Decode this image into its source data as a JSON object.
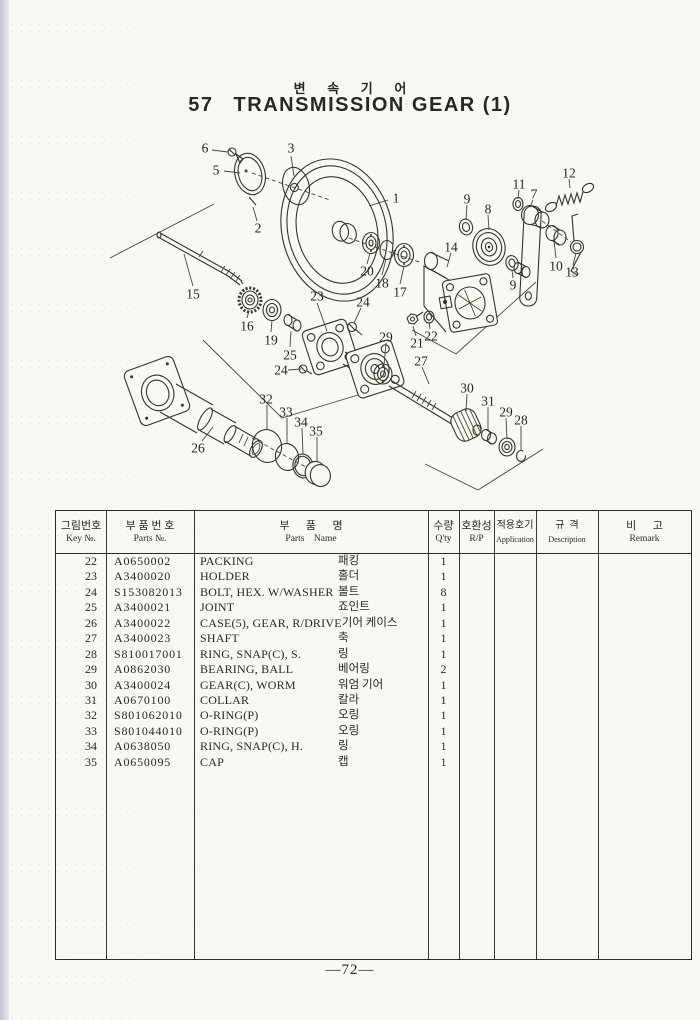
{
  "page": {
    "title_ko": "변 속 기 어",
    "title_no": "57",
    "title_en": "TRANSMISSION GEAR (1)",
    "page_number": "—72—"
  },
  "table": {
    "headers": [
      {
        "ko": "그림번호",
        "en": "Key №."
      },
      {
        "ko": "부 품 번 호",
        "en": "Parts №."
      },
      {
        "ko": "부      품      명",
        "en": "Parts    Name"
      },
      {
        "ko": "수량",
        "en": "Q'ty"
      },
      {
        "ko": "호환성",
        "en": "R/P"
      },
      {
        "ko": "적용호기",
        "en": "Application"
      },
      {
        "ko": "규  격",
        "en": "Description"
      },
      {
        "ko": "비      고",
        "en": "Remark"
      }
    ],
    "rows": [
      {
        "key": "22",
        "part_no": "A0650002",
        "name_en": "PACKING",
        "name_ko": "패킹",
        "qty": "1"
      },
      {
        "key": "23",
        "part_no": "A3400020",
        "name_en": "HOLDER",
        "name_ko": "홀더",
        "qty": "1"
      },
      {
        "key": "24",
        "part_no": "S153082013",
        "name_en": "BOLT, HEX. W/WASHER",
        "name_ko": "볼트",
        "qty": "8"
      },
      {
        "key": "25",
        "part_no": "A3400021",
        "name_en": "JOINT",
        "name_ko": "죠인트",
        "qty": "1"
      },
      {
        "key": "26",
        "part_no": "A3400022",
        "name_en": "CASE(5), GEAR, R/DRIVE",
        "name_ko": "기어 케이스",
        "qty": "1"
      },
      {
        "key": "27",
        "part_no": "A3400023",
        "name_en": "SHAFT",
        "name_ko": "축",
        "qty": "1"
      },
      {
        "key": "28",
        "part_no": "S810017001",
        "name_en": "RING, SNAP(C), S.",
        "name_ko": "링",
        "qty": "1"
      },
      {
        "key": "29",
        "part_no": "A0862030",
        "name_en": "BEARING, BALL",
        "name_ko": "베어링",
        "qty": "2"
      },
      {
        "key": "30",
        "part_no": "A3400024",
        "name_en": "GEAR(C), WORM",
        "name_ko": "워엄 기어",
        "qty": "1"
      },
      {
        "key": "31",
        "part_no": "A0670100",
        "name_en": "COLLAR",
        "name_ko": "칼라",
        "qty": "1"
      },
      {
        "key": "32",
        "part_no": "S801062010",
        "name_en": "O-RING(P)",
        "name_ko": "오링",
        "qty": "1"
      },
      {
        "key": "33",
        "part_no": "S801044010",
        "name_en": "O-RING(P)",
        "name_ko": "오링",
        "qty": "1"
      },
      {
        "key": "34",
        "part_no": "A0638050",
        "name_en": "RING, SNAP(C), H.",
        "name_ko": "링",
        "qty": "1"
      },
      {
        "key": "35",
        "part_no": "A0650095",
        "name_en": "CAP",
        "name_ko": "캡",
        "qty": "1"
      }
    ]
  },
  "diagram": {
    "callouts": [
      {
        "t": "6",
        "x": 205,
        "y": 148
      },
      {
        "t": "5",
        "x": 216,
        "y": 170
      },
      {
        "t": "3",
        "x": 291,
        "y": 148
      },
      {
        "t": "2",
        "x": 258,
        "y": 228
      },
      {
        "t": "1",
        "x": 396,
        "y": 198
      },
      {
        "t": "15",
        "x": 193,
        "y": 294
      },
      {
        "t": "16",
        "x": 247,
        "y": 326
      },
      {
        "t": "19",
        "x": 271,
        "y": 340
      },
      {
        "t": "25",
        "x": 290,
        "y": 355
      },
      {
        "t": "23",
        "x": 317,
        "y": 296
      },
      {
        "t": "24",
        "x": 363,
        "y": 302
      },
      {
        "t": "24",
        "x": 281,
        "y": 370
      },
      {
        "t": "20",
        "x": 367,
        "y": 271
      },
      {
        "t": "18",
        "x": 382,
        "y": 283
      },
      {
        "t": "17",
        "x": 400,
        "y": 292
      },
      {
        "t": "14",
        "x": 451,
        "y": 247
      },
      {
        "t": "9",
        "x": 467,
        "y": 199
      },
      {
        "t": "8",
        "x": 488,
        "y": 209
      },
      {
        "t": "9",
        "x": 513,
        "y": 285
      },
      {
        "t": "11",
        "x": 519,
        "y": 184
      },
      {
        "t": "7",
        "x": 534,
        "y": 194
      },
      {
        "t": "12",
        "x": 569,
        "y": 173
      },
      {
        "t": "10",
        "x": 556,
        "y": 266
      },
      {
        "t": "13",
        "x": 572,
        "y": 272
      },
      {
        "t": "21",
        "x": 417,
        "y": 343
      },
      {
        "t": "22",
        "x": 431,
        "y": 336
      },
      {
        "t": "27",
        "x": 421,
        "y": 361
      },
      {
        "t": "30",
        "x": 467,
        "y": 388
      },
      {
        "t": "31",
        "x": 488,
        "y": 401
      },
      {
        "t": "29",
        "x": 386,
        "y": 337
      },
      {
        "t": "29",
        "x": 506,
        "y": 412
      },
      {
        "t": "28",
        "x": 521,
        "y": 420
      },
      {
        "t": "26",
        "x": 198,
        "y": 448
      },
      {
        "t": "32",
        "x": 266,
        "y": 399
      },
      {
        "t": "33",
        "x": 286,
        "y": 412
      },
      {
        "t": "34",
        "x": 301,
        "y": 422
      },
      {
        "t": "35",
        "x": 316,
        "y": 431
      }
    ]
  },
  "colors": {
    "ink": "#2a2824",
    "paper": "#faf8f2",
    "binding_edge": "#d6d0da"
  }
}
